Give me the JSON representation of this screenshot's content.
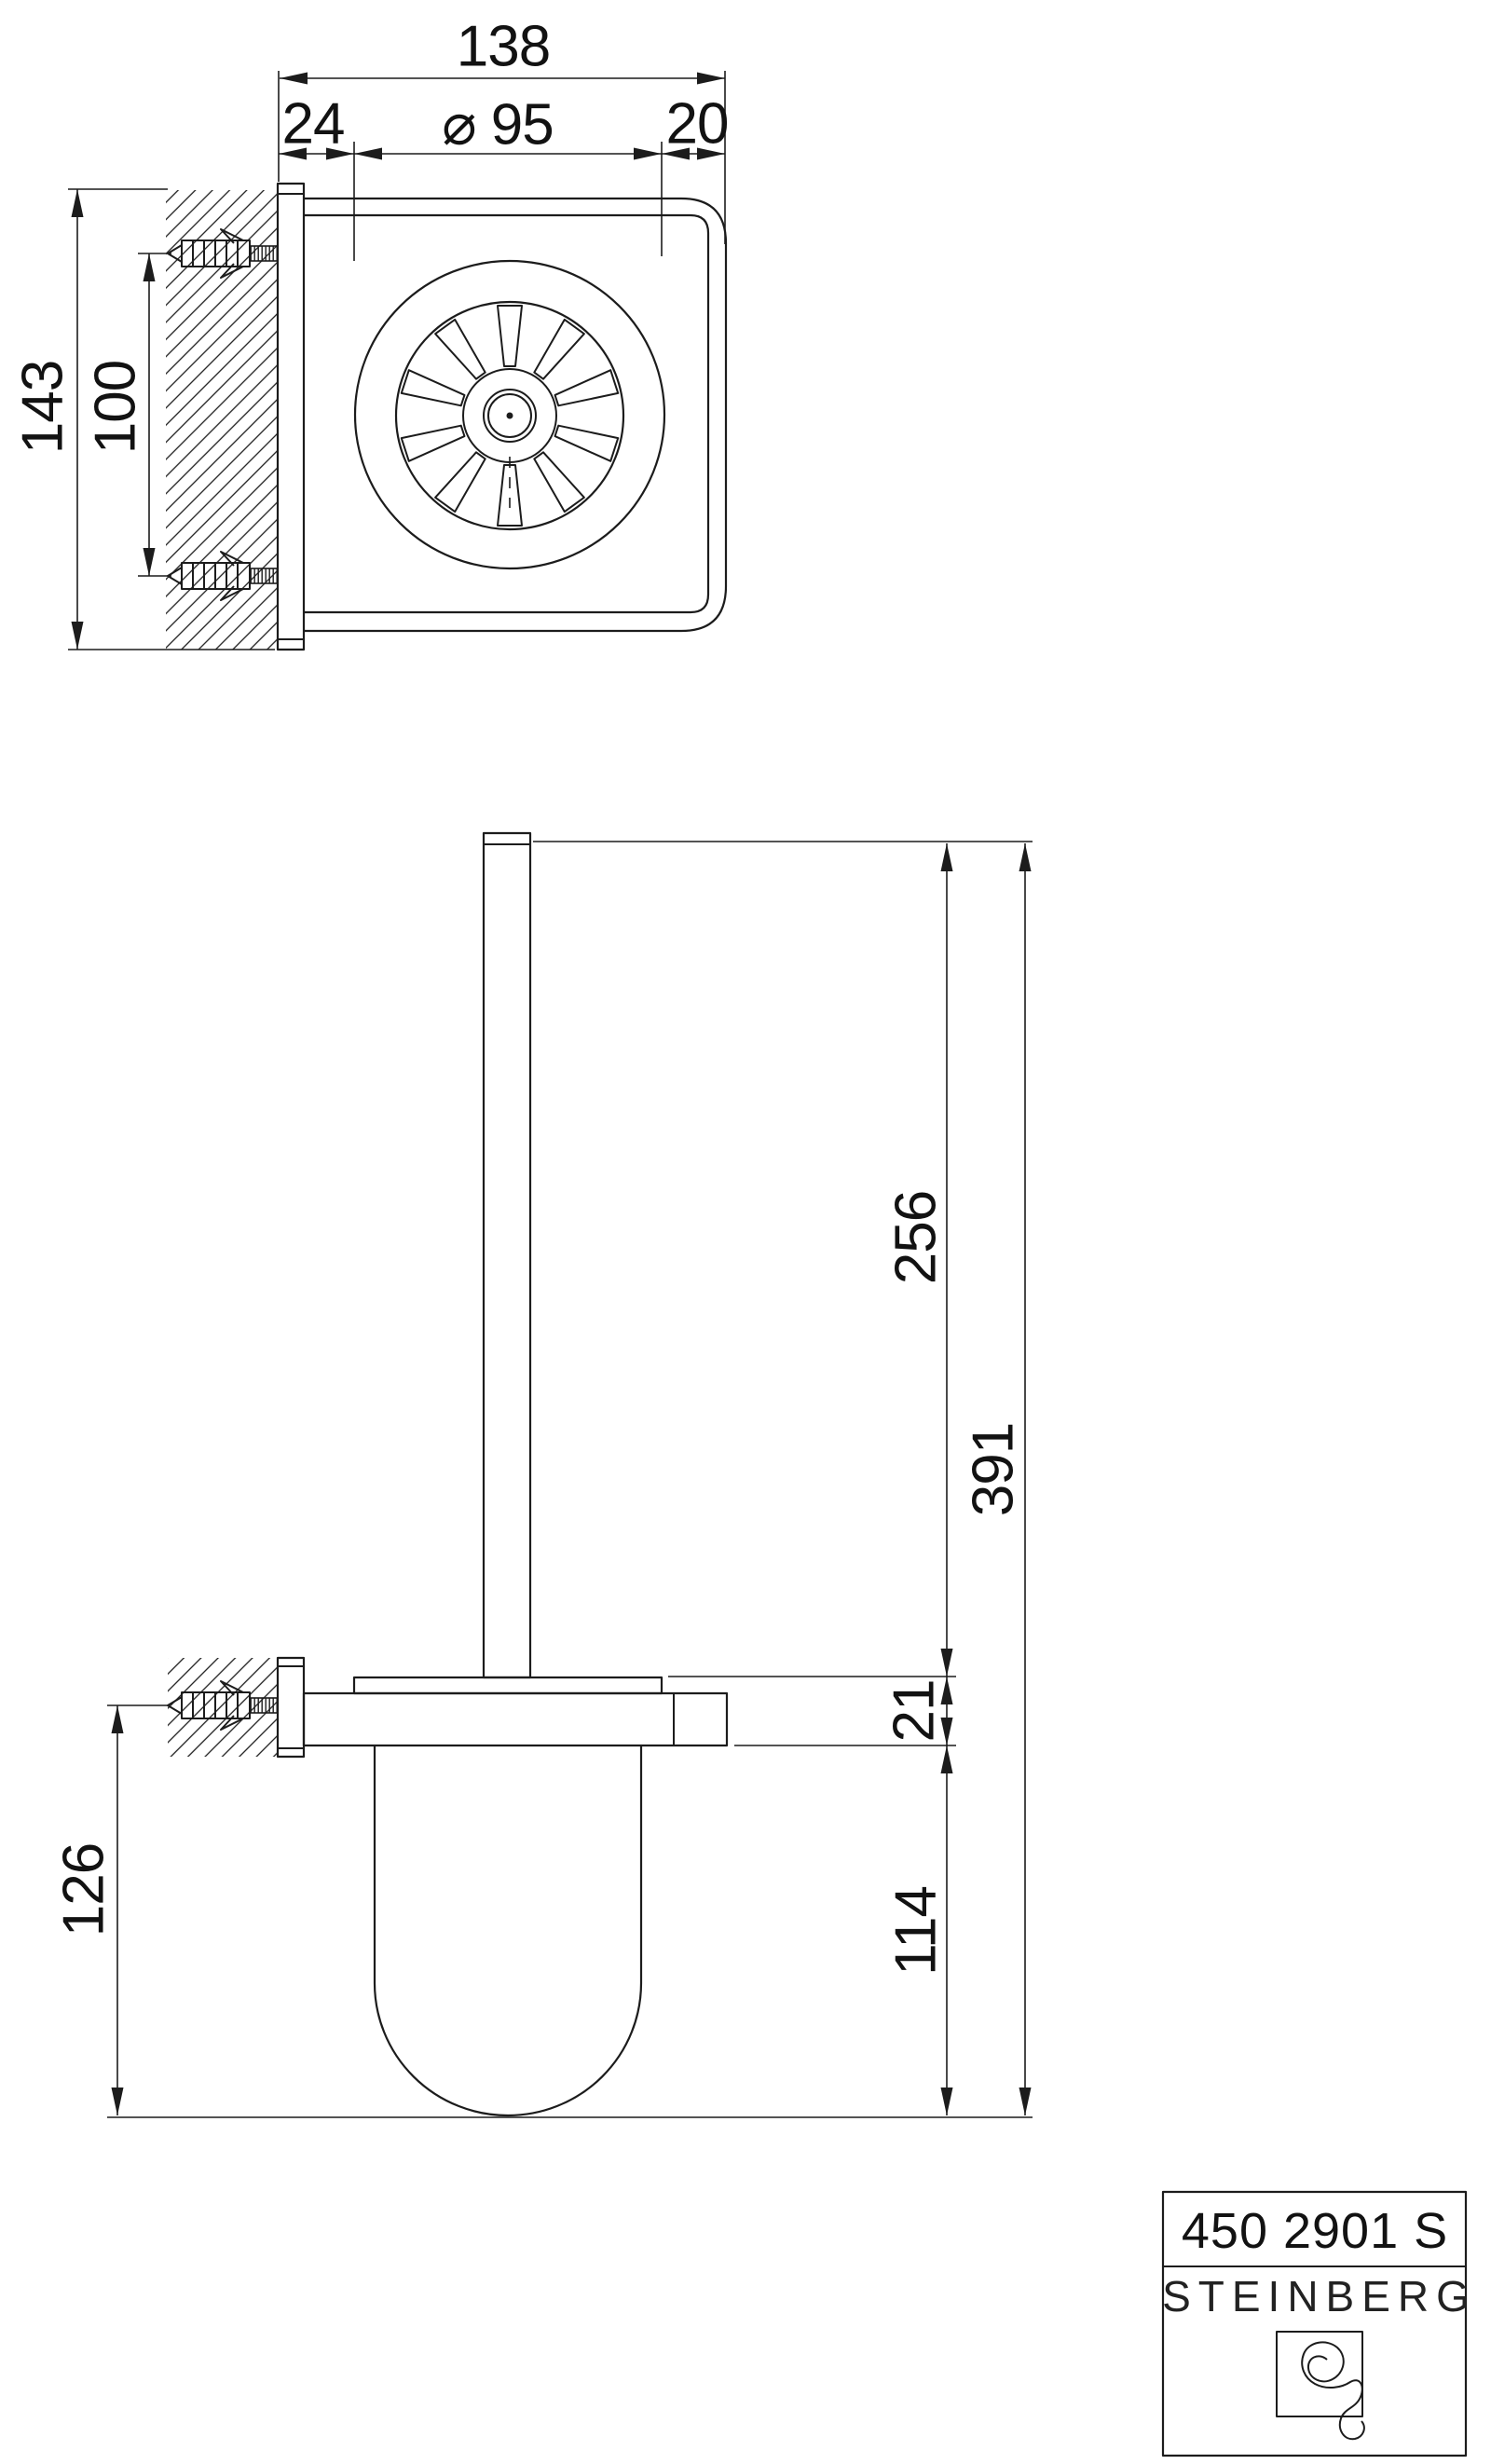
{
  "drawing": {
    "top_view": {
      "dim_width_total": "138",
      "dim_offset_left": "24",
      "dim_diameter": "⌀ 95",
      "dim_offset_right": "20",
      "dim_plate_height": "143",
      "dim_hole_spacing": "100"
    },
    "side_view": {
      "dim_rod_height": "256",
      "dim_total_height": "391",
      "dim_holder_thickness": "21",
      "dim_cup_below_holder": "114",
      "dim_screw_to_bottom": "126"
    },
    "title_block": {
      "model_number": "450 2901 S",
      "brand_name": "STEINBERG"
    },
    "colors": {
      "line": "#1c1c1c",
      "background": "#ffffff"
    }
  }
}
